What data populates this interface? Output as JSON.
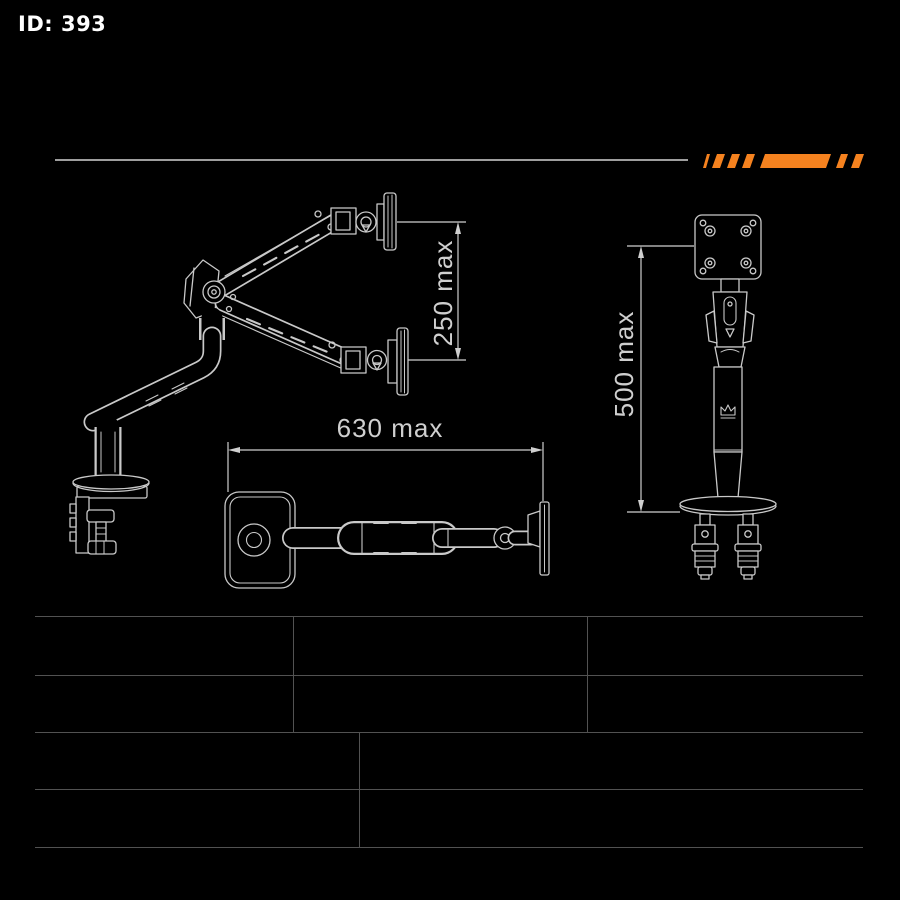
{
  "meta": {
    "id_label": "ID: 393"
  },
  "colors": {
    "background": "#000000",
    "line": "#c9c9c9",
    "dimension": "#cfcfcf",
    "accent": "#F5821F",
    "rule": "#9e9e9e",
    "table_line": "#525252",
    "id_text": "#ffffff"
  },
  "diagram": {
    "side_view": {
      "dimension_label": "250 max"
    },
    "top_view": {
      "dimension_label": "630 max"
    },
    "front_view": {
      "dimension_label": "500 max"
    }
  },
  "spec_table": {
    "rows": [
      {
        "cells": [
          "",
          "",
          ""
        ]
      },
      {
        "cells": [
          "",
          "",
          ""
        ]
      },
      {
        "cells": [
          "",
          ""
        ]
      },
      {
        "cells": [
          "",
          ""
        ]
      }
    ]
  }
}
